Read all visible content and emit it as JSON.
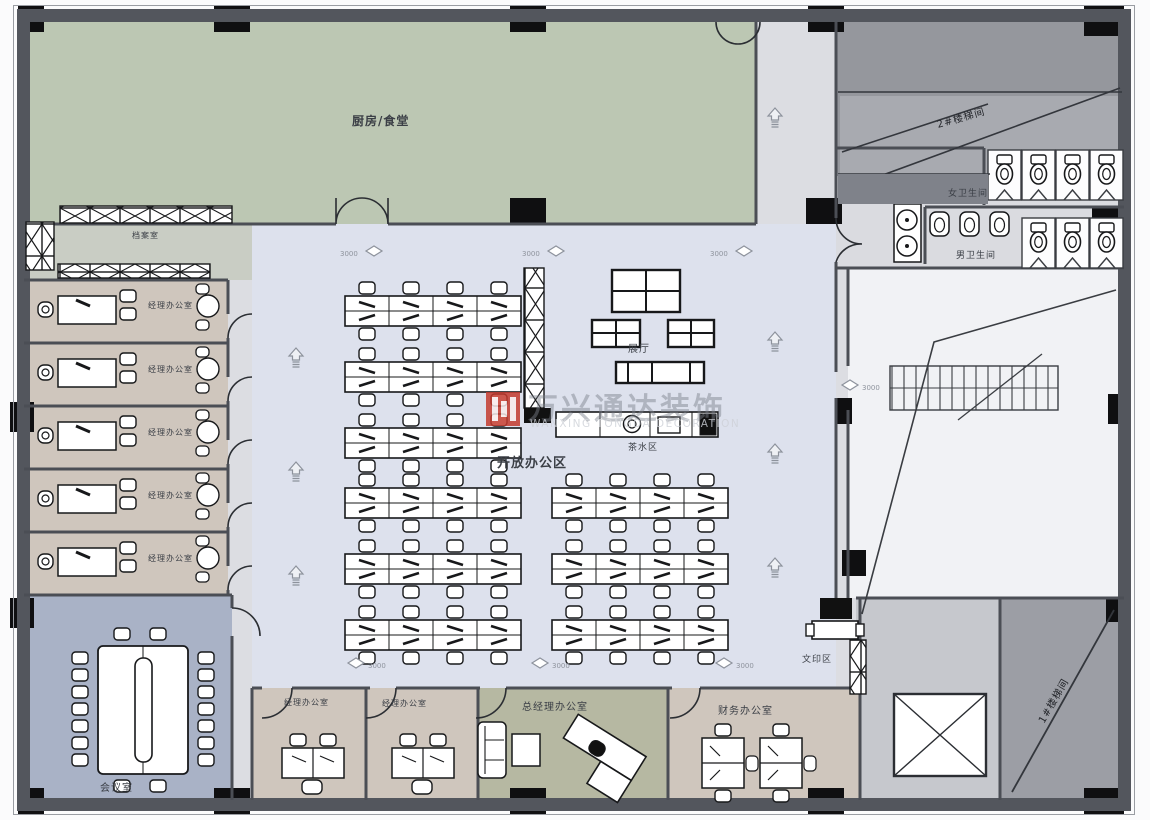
{
  "plan": {
    "labels": {
      "kitchen": "厨房/食堂",
      "archive": "档案室",
      "manager_office": "经理办公室",
      "meeting_room": "会议室",
      "open_office": "开放办公区",
      "exhibition": "展厅",
      "tea_area": "茶水区",
      "print_area": "文印区",
      "gm_office": "总经理办公室",
      "finance_office": "财务办公室",
      "female_wc": "女卫生间",
      "male_wc": "男卫生间",
      "stair_1": "1#楼梯间",
      "stair_2": "2#楼梯间",
      "dim": "3000"
    },
    "watermark": {
      "company_cn": "万兴通达装饰",
      "company_en": "WANXING TONGDA DECORATION",
      "logo_color": "#c43b2e"
    },
    "colors": {
      "wall": "#53565d",
      "kitchen": "#bcc7b3",
      "manager_office": "#cfc6bd",
      "meeting_room": "#a9b2c6",
      "open_office": "#dde1ed",
      "gm_office": "#b6b8a2",
      "archive": "#c9cdc4",
      "corridor": "#dcdde2",
      "stair_dark": "#95979d",
      "stair_room": "#f1f2f5"
    }
  }
}
